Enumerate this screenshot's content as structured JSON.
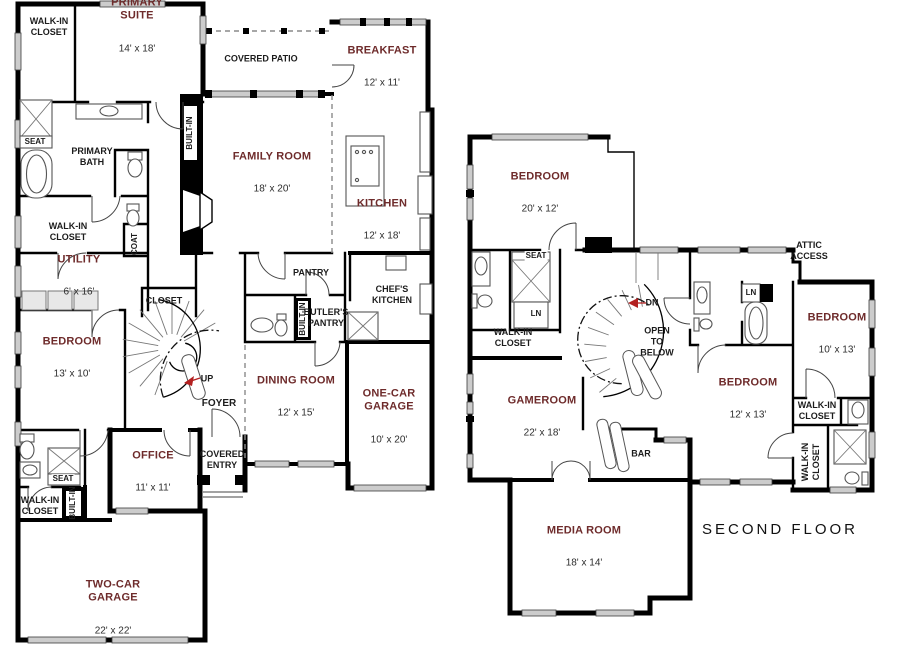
{
  "rooms": {
    "primary_suite": {
      "name": "PRIMARY\nSUITE",
      "dims": "14' x 18'"
    },
    "breakfast": {
      "name": "BREAKFAST",
      "dims": "12' x 11'"
    },
    "family_room": {
      "name": "FAMILY ROOM",
      "dims": "18' x 20'"
    },
    "kitchen": {
      "name": "KITCHEN",
      "dims": "12' x 18'"
    },
    "utility": {
      "name": "UTILITY",
      "dims": "6' x 16'"
    },
    "bedroom_13x10": {
      "name": "BEDROOM",
      "dims": "13' x 10'"
    },
    "dining_room": {
      "name": "DINING ROOM",
      "dims": "12' x 15'"
    },
    "one_car_garage": {
      "name": "ONE-CAR\nGARAGE",
      "dims": "10' x 20'"
    },
    "office": {
      "name": "OFFICE",
      "dims": "11' x 11'"
    },
    "two_car_garage": {
      "name": "TWO-CAR\nGARAGE",
      "dims": "22' x 22'"
    },
    "bedroom_20x12": {
      "name": "BEDROOM",
      "dims": "20' x 12'"
    },
    "gameroom": {
      "name": "GAMEROOM",
      "dims": "22' x 18'"
    },
    "media_room": {
      "name": "MEDIA ROOM",
      "dims": "18' x 14'"
    },
    "bedroom_12x13": {
      "name": "BEDROOM",
      "dims": "12' x 13'"
    },
    "bedroom_10x13": {
      "name": "BEDROOM",
      "dims": "10' x 13'"
    }
  },
  "annotations": {
    "walk_in_closet": "WALK-IN\nCLOSET",
    "covered_patio": "COVERED PATIO",
    "primary_bath": "PRIMARY\nBATH",
    "seat": "SEAT",
    "built_in": "BUILT-IN",
    "coat": "COAT",
    "closet": "CLOSET",
    "pantry": "PANTRY",
    "butlers_pantry": "BUTLER'S\nPANTRY",
    "chefs_kitchen": "CHEF'S\nKITCHEN",
    "foyer": "FOYER",
    "up": "UP",
    "dn": "DN",
    "ln": "LN",
    "covered_entry": "COVERED\nENTRY",
    "open_to_below": "OPEN\nTO\nBELOW",
    "attic_access": "ATTIC\nACCESS",
    "bar": "BAR",
    "second_floor_title": "SECOND  FLOOR"
  },
  "colors": {
    "room_label": "#6e2b2b",
    "dimension_label": "#2d2d2d",
    "annotation_label": "#1c1c1c",
    "wall": "#000000",
    "window": "#cccccc",
    "direction_arrow": "#b32020",
    "background": "#ffffff"
  }
}
